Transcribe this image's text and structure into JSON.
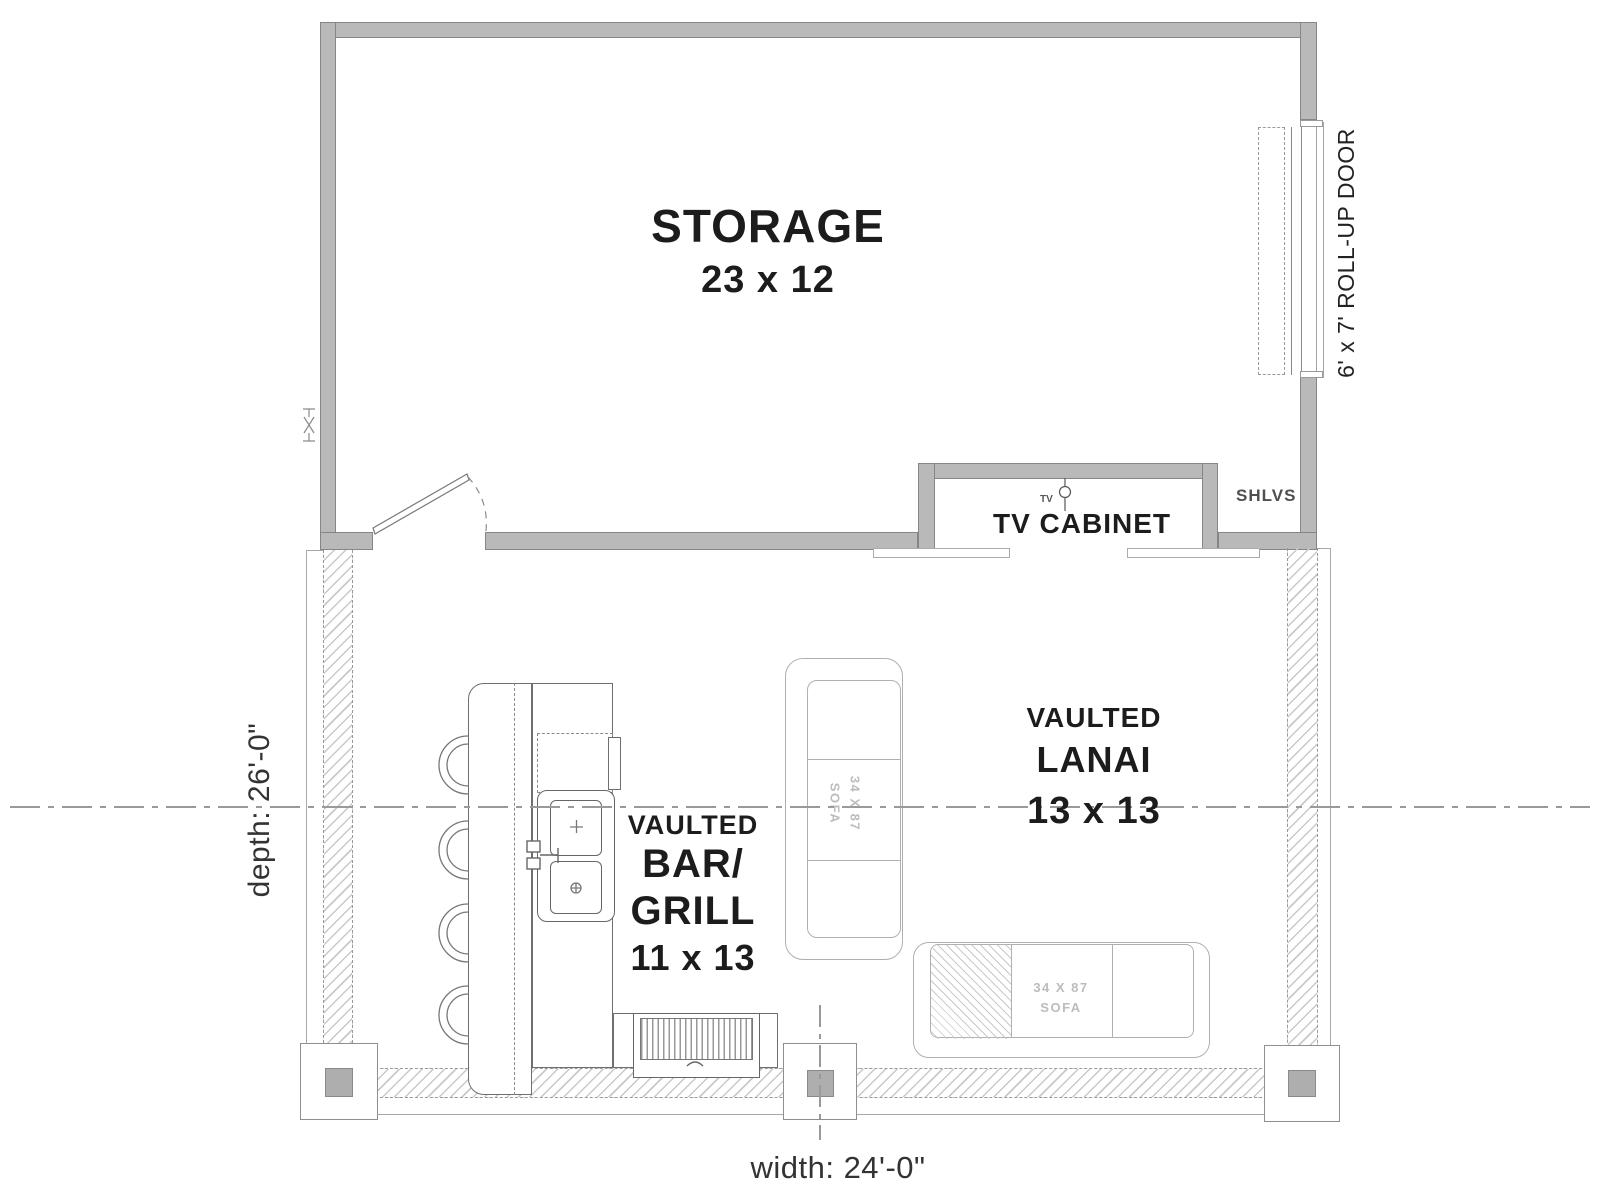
{
  "plan": {
    "rooms": {
      "storage": {
        "name": "STORAGE",
        "dims": "23 x 12"
      },
      "lanai": {
        "modifier": "VAULTED",
        "name": "LANAI",
        "dims": "13 x 13"
      },
      "bar_grill": {
        "modifier": "VAULTED",
        "name_line_1": "BAR/",
        "name_line_2": "GRILL",
        "dims": "11 x 13"
      }
    },
    "features": {
      "rollup_door_label": "6' x 7' ROLL-UP DOOR",
      "tv_cabinet_label": "TV CABINET",
      "tv_outlet_label": "TV",
      "shelves_label": "SHLVS"
    },
    "furniture": {
      "sofa_left": {
        "size": "34 X 87",
        "type": "SOFA"
      },
      "sofa_bottom": {
        "size": "34 X 87",
        "type": "SOFA"
      }
    },
    "dimensions": {
      "depth_label": "depth: 26'-0\"",
      "width_label": "width: 24'-0\""
    },
    "colors": {
      "wall_fill": "#b9b9b9",
      "wall_edge": "#868686",
      "hatch_line": "#c9c9c9",
      "dash_line": "#9a9a9a",
      "furniture_line": "#6f6f6f",
      "sofa_line": "#b0b0b0",
      "sofa_text": "#bcbcbc",
      "label_text": "#1c1c1c",
      "dim_text": "#333333"
    }
  }
}
